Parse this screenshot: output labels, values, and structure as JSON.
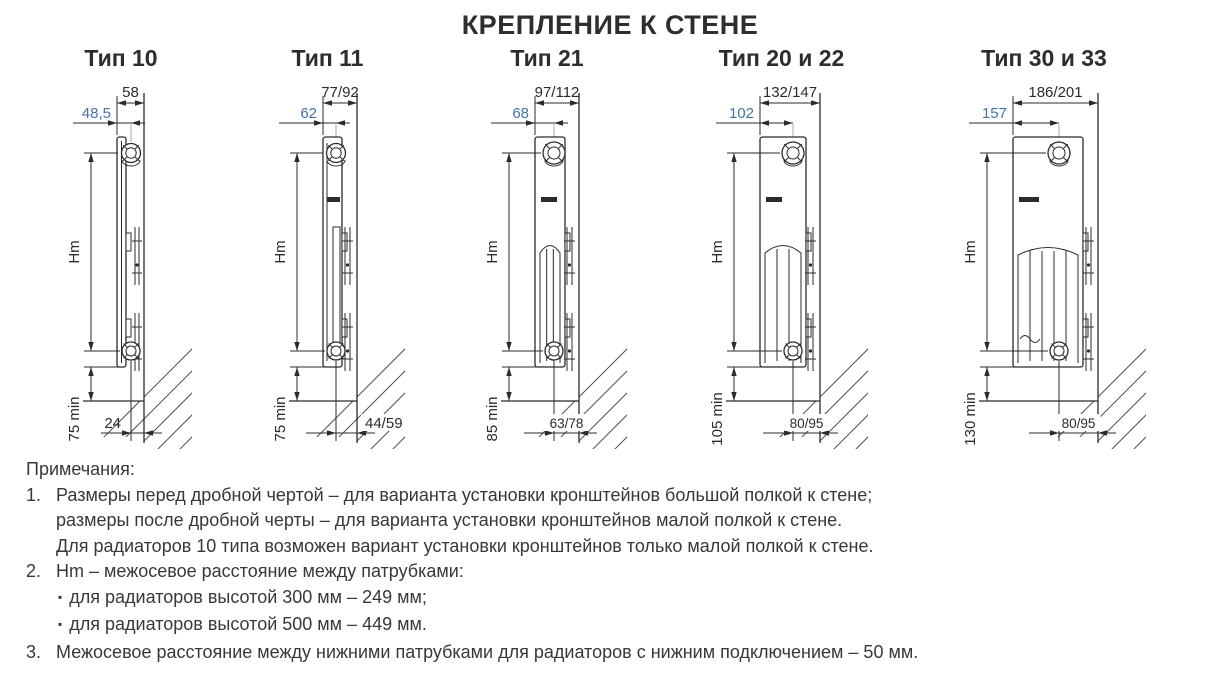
{
  "page": {
    "heading": "КРЕПЛЕНИЕ К СТЕНЕ"
  },
  "colors": {
    "dim_accent": "#4373aa",
    "line": "#2b2b2b",
    "notes_text": "#383838"
  },
  "diagrams": [
    {
      "id": "tip-10",
      "title": "Тип 10",
      "dim_top": "58",
      "dim_front": "48,5",
      "hm_label": "Hm",
      "min_label": "75 min",
      "dim_bottom": "24"
    },
    {
      "id": "tip-11",
      "title": "Тип 11",
      "dim_top": "77/92",
      "dim_front": "62",
      "hm_label": "Hm",
      "min_label": "75 min",
      "dim_bottom": "44/59"
    },
    {
      "id": "tip-21",
      "title": "Тип 21",
      "dim_top": "97/112",
      "dim_front": "68",
      "hm_label": "Hm",
      "min_label": "85 min",
      "dim_bottom": "63/78"
    },
    {
      "id": "tip-20-22",
      "title": "Тип 20 и 22",
      "dim_top": "132/147",
      "dim_front": "102",
      "hm_label": "Hm",
      "min_label": "105 min",
      "dim_bottom": "80/95"
    },
    {
      "id": "tip-30-33",
      "title": "Тип 30 и 33",
      "dim_top": "186/201",
      "dim_front": "157",
      "hm_label": "Hm",
      "min_label": "130 min",
      "dim_bottom": "80/95"
    }
  ],
  "notes": {
    "heading": "Примечания:",
    "items": [
      {
        "num": "1.",
        "lines": [
          "Размеры перед дробной чертой – для варианта установки кронштейнов большой полкой к стене;",
          "размеры после дробной черты – для варианта установки кронштейнов малой полкой к стене.",
          "Для радиаторов 10 типа возможен вариант установки кронштейнов только малой полкой к стене."
        ]
      },
      {
        "num": "2.",
        "lines": [
          "Hm – межосевое расстояние между патрубками:"
        ],
        "bullets": [
          "для радиаторов высотой 300 мм – 249 мм;",
          "для радиаторов высотой 500 мм – 449 мм."
        ]
      },
      {
        "num": "3.",
        "lines": [
          "Межосевое расстояние между нижними патрубками для радиаторов с нижним подключением – 50 мм."
        ]
      }
    ]
  }
}
